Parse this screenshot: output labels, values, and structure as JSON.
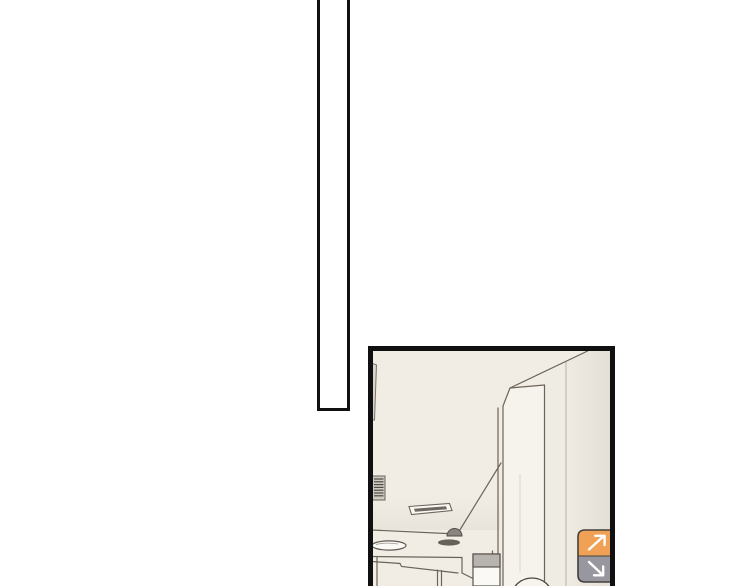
{
  "reader": {
    "description": "Webtoon reader page with two comic panels and floating scroll buttons",
    "panels": [
      {
        "name": "empty-tall-panel",
        "content": "blank white panel, cropped at top of viewport"
      },
      {
        "name": "interior-scene-panel",
        "content": "room interior: ceiling with vent grille, recessed light fixture, dome camera on soffit beam, large pillar, lower counters, gray-topped box, top of a head at bottom edge"
      }
    ]
  },
  "controls": {
    "scroll_up_button": {
      "icon": "arrow-up-right-icon"
    },
    "scroll_down_button": {
      "icon": "arrow-down-right-icon"
    }
  },
  "colors": {
    "page_bg": "#ffffff",
    "panel_border": "#101010",
    "panel_bg": "#f1ede5",
    "pillar_face": "#f6f3ec",
    "wall_mid": "#efece4",
    "accent_orange": "#f0a156",
    "button_gray": "#98969f",
    "button_outline": "#42403c",
    "arrow_white": "#ffffff",
    "line_ink": "#6b645a",
    "dome_gray": "#8a8580",
    "dome_shadow": "#57524b",
    "box_top_gray": "#b7b3ae",
    "frame_sliver": "#d9d5cd"
  }
}
